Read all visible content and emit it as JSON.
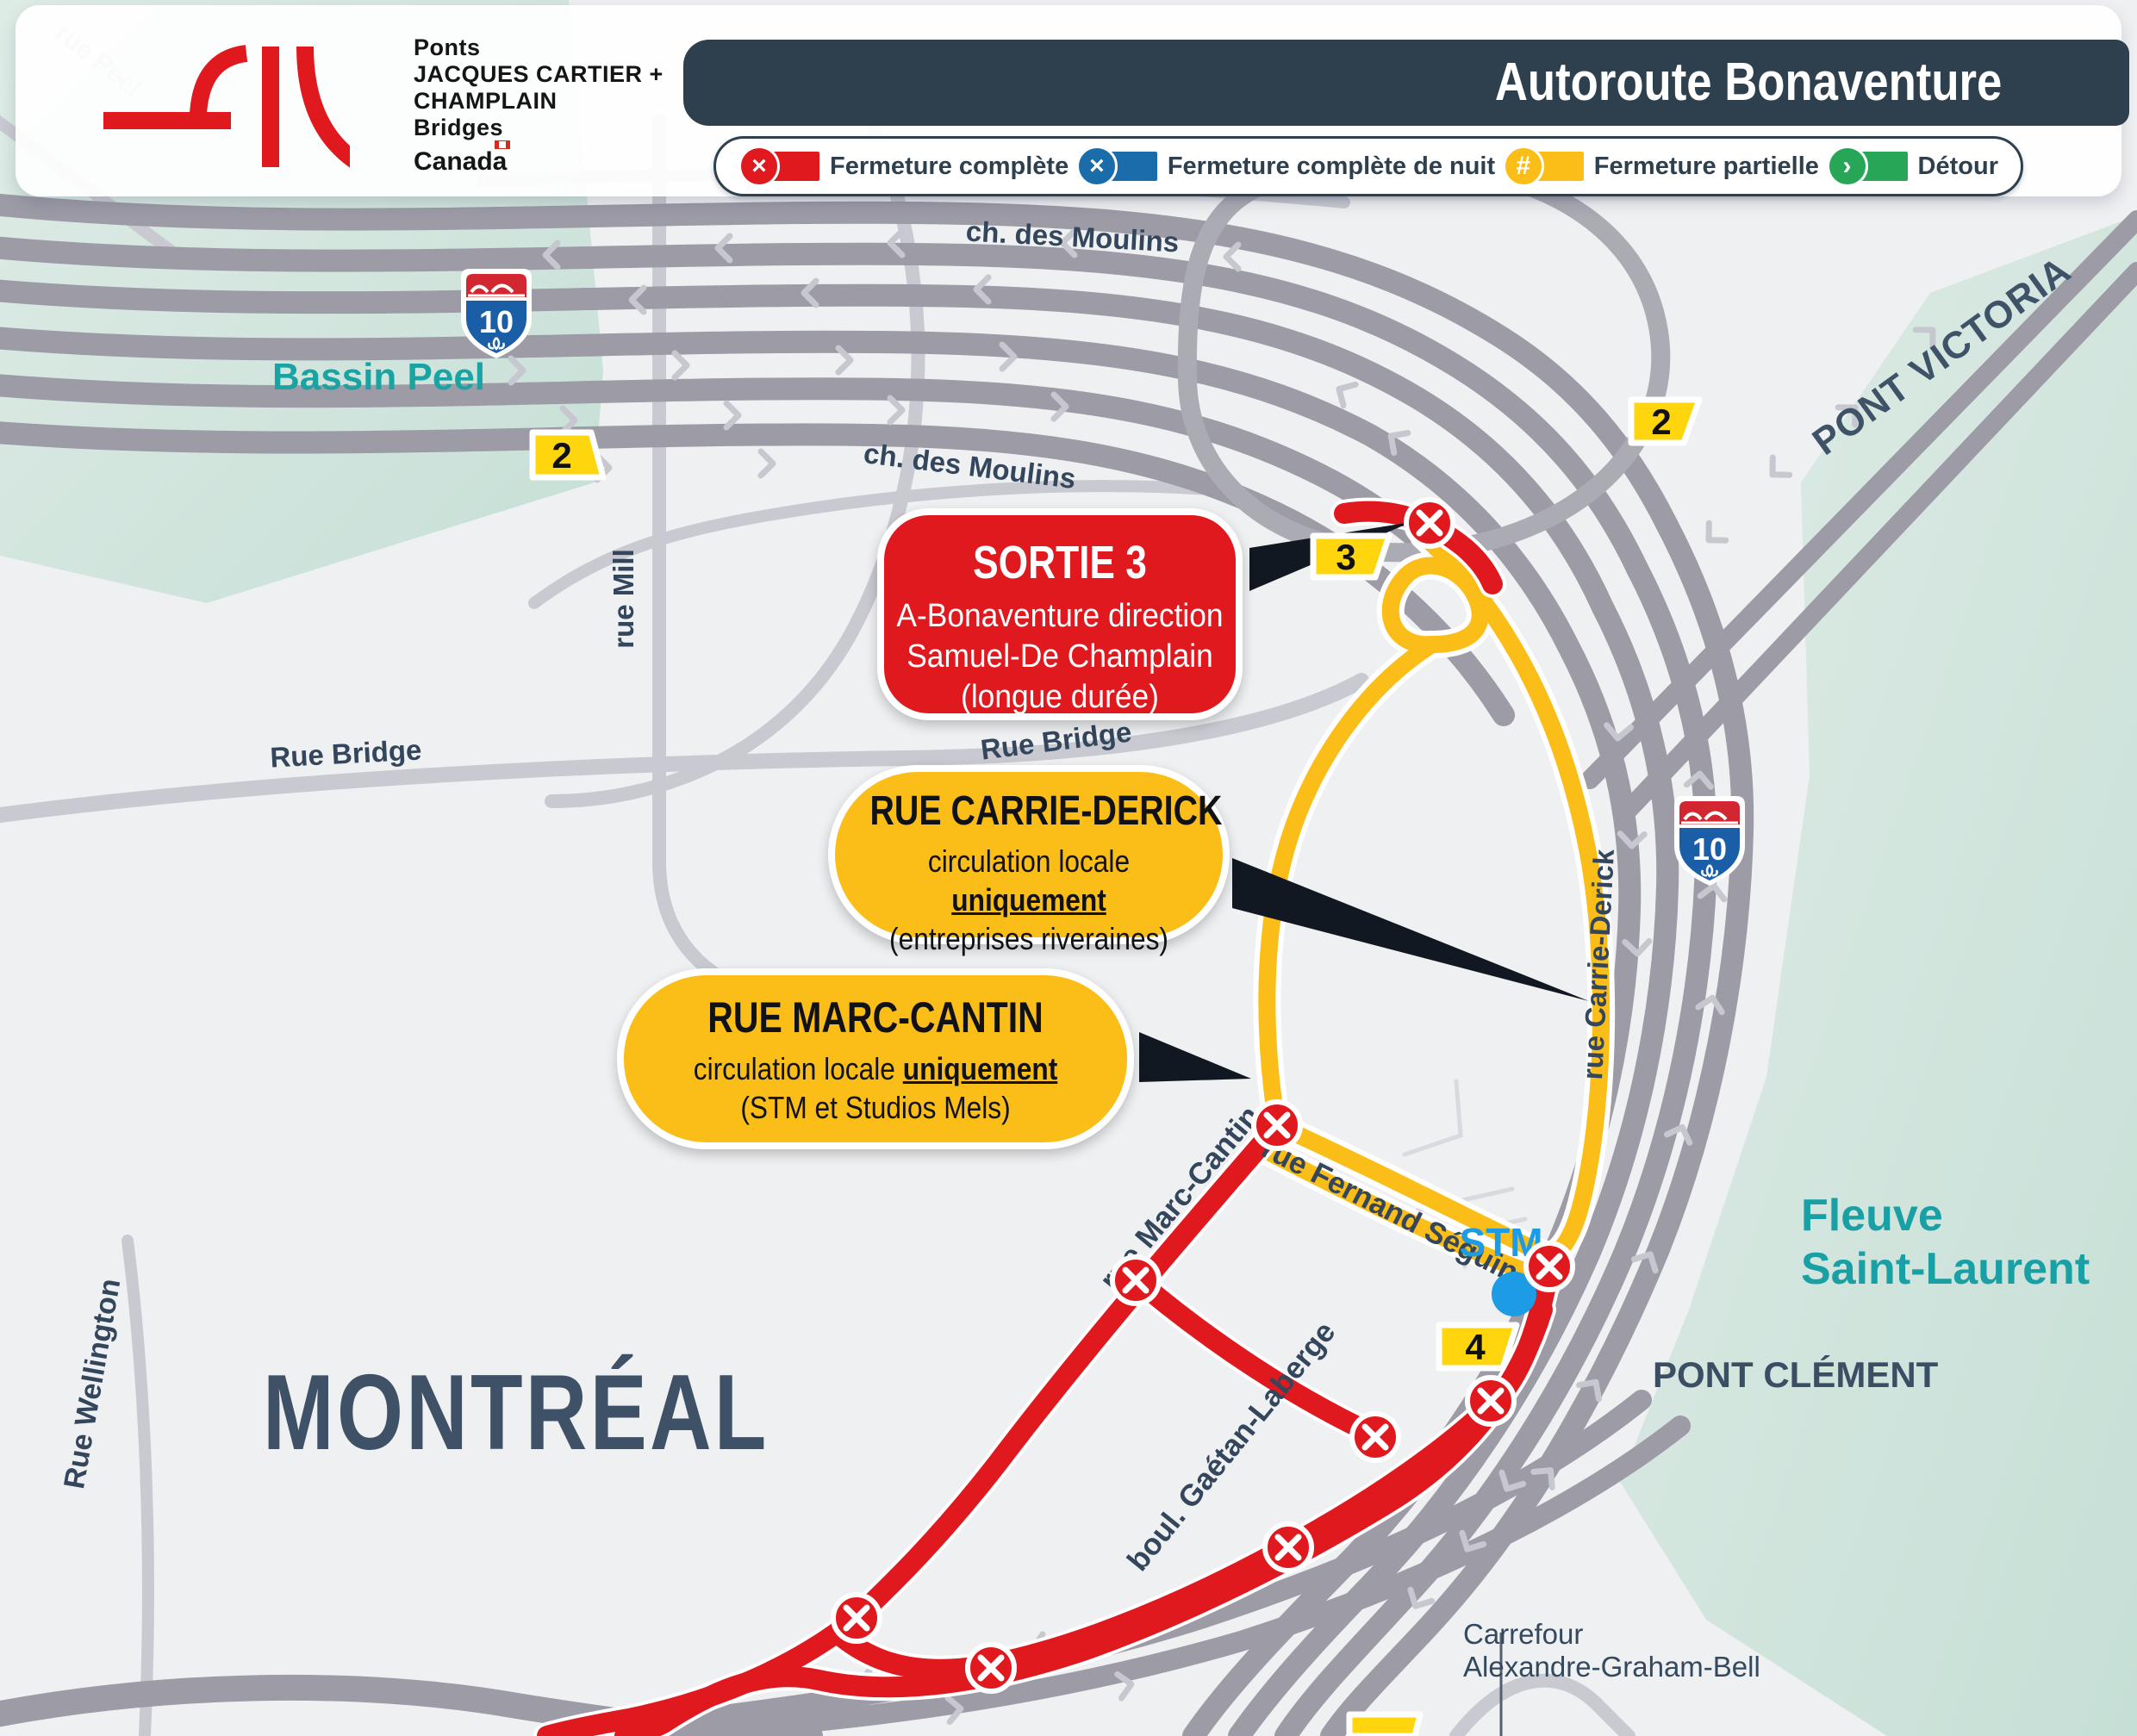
{
  "header": {
    "brand": {
      "line1": "Ponts",
      "line2": "JACQUES CARTIER +",
      "line3": "CHAMPLAIN",
      "line4": "Bridges",
      "wordmark": "Canada"
    },
    "title": "Autoroute Bonaventure"
  },
  "legend": {
    "items": [
      {
        "symbol": "×",
        "label": "Fermeture complète",
        "color": "#E0191F"
      },
      {
        "symbol": "×",
        "label": "Fermeture complète de nuit",
        "color": "#1B6CAB"
      },
      {
        "symbol": "#",
        "label": "Fermeture partielle",
        "color": "#FBBD17"
      },
      {
        "symbol": "›",
        "label": "Détour",
        "color": "#27A658"
      }
    ]
  },
  "callouts": {
    "sortie3": {
      "title": "SORTIE 3",
      "line1": "A-Bonaventure direction",
      "line2": "Samuel-De Champlain",
      "line3": "(longue durée)"
    },
    "carrie_derick": {
      "title": "RUE CARRIE-DERICK",
      "body_pre": "circulation locale ",
      "body_em": "uniquement",
      "line2": "(entreprises riveraines)"
    },
    "marc_cantin": {
      "title": "RUE MARC-CANTIN",
      "body_pre": "circulation locale ",
      "body_em": "uniquement",
      "line2": "(STM et Studios Mels)"
    }
  },
  "badges": {
    "zone2_left": "2",
    "zone2_right": "2",
    "zone3": "3",
    "zone4": "4"
  },
  "shield": {
    "route_number": "10"
  },
  "map_labels": {
    "rue_peel": "rue Peel",
    "ch_des_moulins_top": "ch. des Moulins",
    "ch_des_moulins_mid": "ch. des Moulins",
    "bassin_peel": "Bassin Peel",
    "rue_mill": "rue Mill",
    "rue_bridge_left": "Rue Bridge",
    "rue_bridge_mid": "Rue Bridge",
    "pont_victoria": "PONT VICTORIA",
    "rue_carrie_derick": "rue Carrie-Derick",
    "rue_marc_cantin": "rue Marc-Cantin",
    "rue_fernand_seguin": "rue Fernand Séguin",
    "stm": "STM",
    "boul_gaetan_laberge": "boul. Gaétan-Laberge",
    "montreal": "MONTRÉAL",
    "rue_wellington": "Rue Wellington",
    "fleuve_line1": "Fleuve",
    "fleuve_line2": "Saint-Laurent",
    "pont_clement": "PONT CLÉMENT",
    "carrefour_line1": "Carrefour",
    "carrefour_line2": "Alexandre-Graham-Bell"
  },
  "colors": {
    "header_navy": "#2E3F4E",
    "closure_red": "#E0191F",
    "night_blue": "#1B6CAB",
    "partial_yellow": "#FBBD17",
    "detour_green": "#27A658",
    "road_gray": "#9C9BA6",
    "water": "#D5E6DE",
    "label_slate": "#33465C",
    "teal_label": "#18A0A5",
    "stm_blue": "#1D9CE5",
    "badge_yellow": "#FFD60E"
  }
}
